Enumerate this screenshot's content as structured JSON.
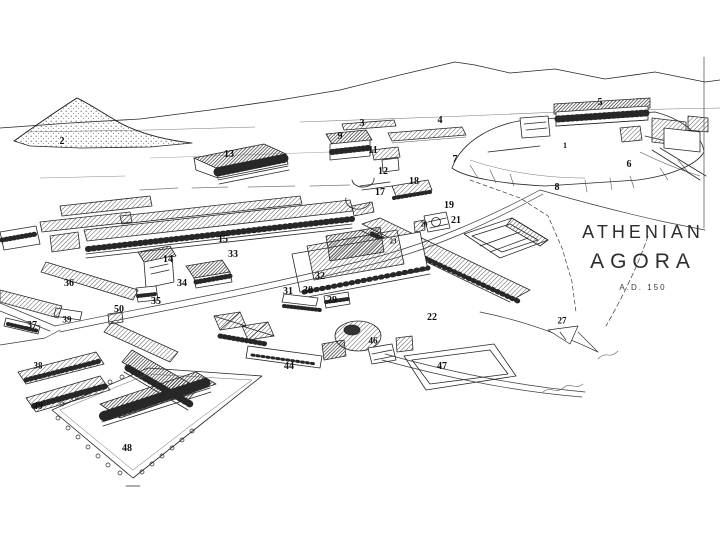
{
  "meta": {
    "width": 720,
    "height": 540,
    "background": "#ffffff",
    "ink_color": "#272727"
  },
  "title": {
    "line1": "ATHENIAN",
    "line2": "AGORA",
    "subtitle": "A.D. 150"
  },
  "map": {
    "description": "Hand-drawn aerial reconstruction of the Athenian Agora with numbered buildings, hills and roads",
    "labels": [
      {
        "n": "1",
        "x": 565,
        "y": 146,
        "s": 8
      },
      {
        "n": "2",
        "x": 62,
        "y": 142,
        "s": 10
      },
      {
        "n": "3",
        "x": 362,
        "y": 124,
        "s": 10
      },
      {
        "n": "4",
        "x": 440,
        "y": 121,
        "s": 10
      },
      {
        "n": "5",
        "x": 600,
        "y": 103,
        "s": 10
      },
      {
        "n": "6",
        "x": 629,
        "y": 165,
        "s": 10
      },
      {
        "n": "7",
        "x": 455,
        "y": 160,
        "s": 10
      },
      {
        "n": "8",
        "x": 557,
        "y": 188,
        "s": 10
      },
      {
        "n": "9",
        "x": 340,
        "y": 137,
        "s": 10
      },
      {
        "n": "11",
        "x": 373,
        "y": 151,
        "s": 10
      },
      {
        "n": "12",
        "x": 383,
        "y": 172,
        "s": 10
      },
      {
        "n": "13",
        "x": 229,
        "y": 155,
        "s": 10
      },
      {
        "n": "14",
        "x": 168,
        "y": 260,
        "s": 10
      },
      {
        "n": "15",
        "x": 223,
        "y": 240,
        "s": 10
      },
      {
        "n": "17",
        "x": 380,
        "y": 193,
        "s": 10
      },
      {
        "n": "18",
        "x": 414,
        "y": 182,
        "s": 10
      },
      {
        "n": "19",
        "x": 449,
        "y": 206,
        "s": 10
      },
      {
        "n": "20",
        "x": 424,
        "y": 225,
        "s": 7
      },
      {
        "n": "21",
        "x": 456,
        "y": 221,
        "s": 10
      },
      {
        "n": "22",
        "x": 432,
        "y": 318,
        "s": 10
      },
      {
        "n": "23",
        "x": 393,
        "y": 242,
        "s": 7
      },
      {
        "n": "27",
        "x": 562,
        "y": 321,
        "s": 9
      },
      {
        "n": "29",
        "x": 332,
        "y": 301,
        "s": 10
      },
      {
        "n": "30",
        "x": 308,
        "y": 291,
        "s": 10
      },
      {
        "n": "31",
        "x": 288,
        "y": 292,
        "s": 10
      },
      {
        "n": "32",
        "x": 320,
        "y": 277,
        "s": 10
      },
      {
        "n": "33",
        "x": 233,
        "y": 255,
        "s": 10
      },
      {
        "n": "34",
        "x": 182,
        "y": 284,
        "s": 10
      },
      {
        "n": "35",
        "x": 156,
        "y": 302,
        "s": 10
      },
      {
        "n": "36",
        "x": 69,
        "y": 284,
        "s": 10
      },
      {
        "n": "37",
        "x": 32,
        "y": 326,
        "s": 10
      },
      {
        "n": "38",
        "x": 38,
        "y": 366,
        "s": 9
      },
      {
        "n": "39",
        "x": 67,
        "y": 320,
        "s": 9
      },
      {
        "n": "44",
        "x": 289,
        "y": 367,
        "s": 10
      },
      {
        "n": "46",
        "x": 373,
        "y": 341,
        "s": 9
      },
      {
        "n": "47",
        "x": 442,
        "y": 367,
        "s": 10
      },
      {
        "n": "48",
        "x": 127,
        "y": 449,
        "s": 10
      },
      {
        "n": "49",
        "x": 38,
        "y": 407,
        "s": 10
      },
      {
        "n": "50",
        "x": 119,
        "y": 310,
        "s": 10
      }
    ]
  }
}
